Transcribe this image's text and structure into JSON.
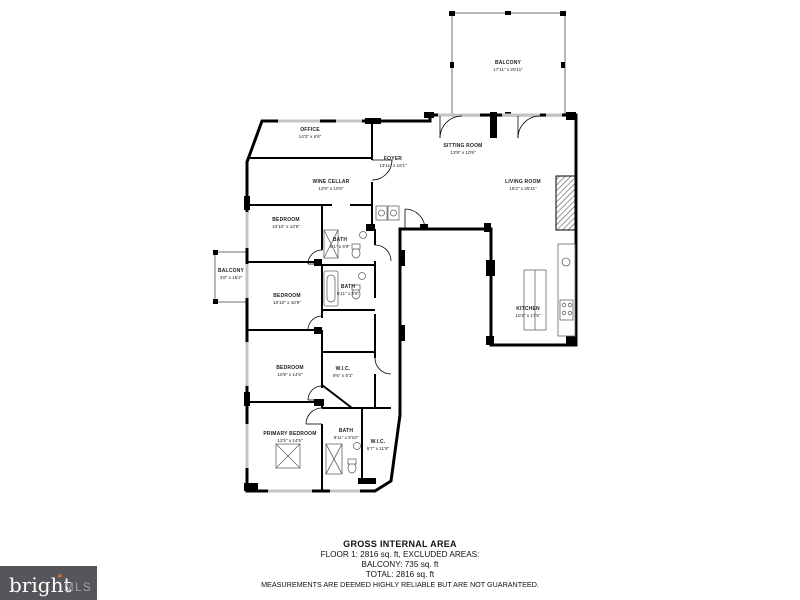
{
  "floorplan": {
    "rooms": [
      {
        "name": "BALCONY",
        "dims": "17'11\" x 20'11\""
      },
      {
        "name": "OFFICE",
        "dims": "14'3\" x 6'6\""
      },
      {
        "name": "WINE CELLAR",
        "dims": "13'9\" x 10'8\""
      },
      {
        "name": "BEDROOM",
        "dims": "10'10\" x 13'5\""
      },
      {
        "name": "BALCONY",
        "dims": "4'8\" x 15'2\""
      },
      {
        "name": "BEDROOM",
        "dims": "10'10\" x 10'9\""
      },
      {
        "name": "BEDROOM",
        "dims": "10'9\" x 14'6\""
      },
      {
        "name": "PRIMARY BEDROOM",
        "dims": "12'5\" x 14'5\""
      },
      {
        "name": "BATH",
        "dims": "9'1\" x 6'9\""
      },
      {
        "name": "BATH",
        "dims": "6'11\" x 9'8\""
      },
      {
        "name": "W.I.C.",
        "dims": "9'6\" x 6'1\""
      },
      {
        "name": "BATH",
        "dims": "8'11\" x 6'10\""
      },
      {
        "name": "W.I.C.",
        "dims": "5'7\" x 11'8\""
      },
      {
        "name": "FOYER",
        "dims": "13'11\" x 16'1\""
      },
      {
        "name": "SITTING ROOM",
        "dims": "13'9\" x 10'9\""
      },
      {
        "name": "LIVING ROOM",
        "dims": "15'2\" x 25'11\""
      },
      {
        "name": "KITCHEN",
        "dims": "10'2\" x 17'5\""
      }
    ],
    "footer": {
      "title": "GROSS INTERNAL AREA",
      "area_line": "FLOOR 1: 2816 sq. ft, EXCLUDED AREAS:",
      "balcony_line": "BALCONY: 735 sq. ft",
      "total_line": "TOTAL: 2816 sq. ft",
      "disclaimer": "MEASUREMENTS ARE DEEMED HIGHLY RELIABLE BUT ARE NOT GUARANTEED."
    },
    "logo": {
      "brand": "bright",
      "star": "✶",
      "suffix": "MLS"
    },
    "colors": {
      "wall": "#000000",
      "background": "#ffffff",
      "logo_bg": "#54565a",
      "logo_accent": "#f26633",
      "logo_suffix_text": "#a2a4a7"
    }
  }
}
